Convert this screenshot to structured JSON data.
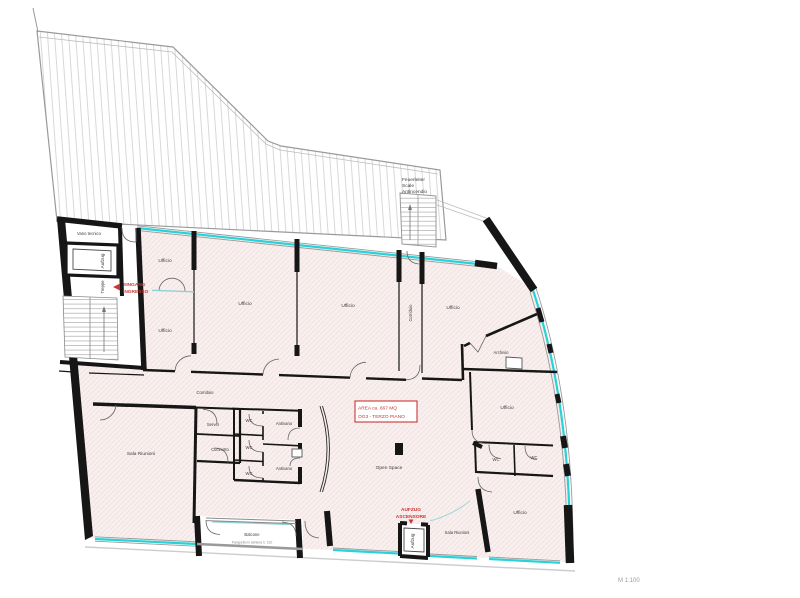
{
  "drawing": {
    "type": "architectural-floor-plan",
    "scale_label": "M 1:100",
    "colors": {
      "glazing_cyan": "#27d3d8",
      "annotation_red": "#c93636",
      "room_fill_pink": "#f8efee",
      "wall_black": "#161616",
      "terrace_line_gray": "#c0c0c0"
    }
  },
  "rooms": [
    {
      "id": "vano-tecnico",
      "label": "Vano tecnico"
    },
    {
      "id": "aufzug-top",
      "label": "Aufzug"
    },
    {
      "id": "treppe",
      "label": "Treppe"
    },
    {
      "id": "ufficio-1",
      "label": "Ufficio"
    },
    {
      "id": "ufficio-2",
      "label": "Ufficio"
    },
    {
      "id": "ufficio-3",
      "label": "Ufficio"
    },
    {
      "id": "ufficio-4",
      "label": "Ufficio"
    },
    {
      "id": "corridoio-vertical",
      "label": "Corridoio"
    },
    {
      "id": "ufficio-5",
      "label": "Ufficio"
    },
    {
      "id": "archivio",
      "label": "Archivio"
    },
    {
      "id": "corridoio-main",
      "label": "Corridoio"
    },
    {
      "id": "server",
      "label": "Server"
    },
    {
      "id": "cucinotto",
      "label": "Cucinotto"
    },
    {
      "id": "wc-1",
      "label": "WC"
    },
    {
      "id": "wc-2",
      "label": "WC"
    },
    {
      "id": "wc-3",
      "label": "WC"
    },
    {
      "id": "antivano-1",
      "label": "Antivano"
    },
    {
      "id": "antivano-2",
      "label": "Antivano"
    },
    {
      "id": "sala-riunioni-1",
      "label": "Sala Riunioni"
    },
    {
      "id": "open-space",
      "label": "Open Space"
    },
    {
      "id": "balcone",
      "label": "Balcone"
    },
    {
      "id": "aufzug-bottom",
      "label": "Aufzug"
    },
    {
      "id": "sala-riunioni-2",
      "label": "Sala Riunioni"
    },
    {
      "id": "ufficio-6",
      "label": "Ufficio"
    },
    {
      "id": "wc-4",
      "label": "WC"
    },
    {
      "id": "wc-5",
      "label": "WC"
    },
    {
      "id": "ufficio-7",
      "label": "Ufficio"
    }
  ],
  "annotations": {
    "entrance": {
      "line1": "EINGANG",
      "line2": "INGRESSO"
    },
    "elevator": {
      "line1": "AUFZUG",
      "line2": "ASCENSORE"
    },
    "fire_stair": {
      "line1": "Feuerleiter",
      "line2": "Scale",
      "line3": "Antincendio"
    },
    "area_box": {
      "line1": "AREA  ca. 667 MQ",
      "line2": "OG3 - TERZO PIANO"
    },
    "parapet_note": "Parapetto in lamiera h. 110",
    "scale_label": "M 1:100"
  }
}
